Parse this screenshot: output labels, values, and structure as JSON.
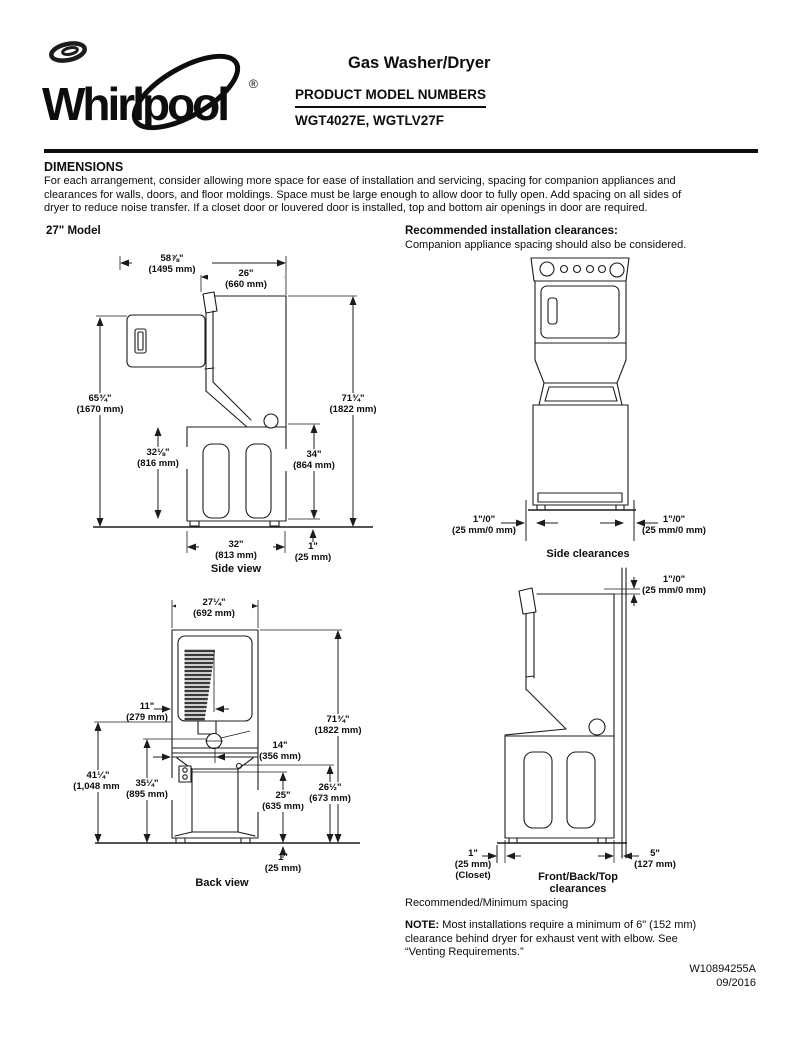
{
  "header": {
    "brand": "Whirlpool",
    "registered": "®",
    "product_title": "Gas Washer/Dryer",
    "subtitle": "PRODUCT MODEL NUMBERS",
    "model_numbers": "WGT4027E, WGTLV27F"
  },
  "intro": {
    "heading": "DIMENSIONS",
    "line1": "For each arrangement, consider allowing more space for ease of installation and servicing, spacing for companion appliances and",
    "line2": "clearances for walls, doors, and floor moldings. Space must be large enough to allow door to fully open. Add spacing on all sides of",
    "line3": "dryer to reduce noise transfer. If a closet door or louvered door is installed, top and bottom air openings in door are required.",
    "left_heading": "27\" Model",
    "right_heading": "Recommended installation clearances:",
    "right_subtext": "Companion appliance spacing should also be considered."
  },
  "side_view": {
    "caption": "Side view",
    "depth_total_in": "58⅞\"",
    "depth_total_mm": "(1495 mm)",
    "depth_top_in": "26\"",
    "depth_top_mm": "(660 mm)",
    "height_door_in": "65¾\"",
    "height_door_mm": "(1670 mm)",
    "height_total_in": "71¾\"",
    "height_total_mm": "(1822 mm)",
    "washer_height_left_in": "32⅛\"",
    "washer_height_left_mm": "(816 mm)",
    "washer_height_right_in": "34\"",
    "washer_height_right_mm": "(864 mm)",
    "base_depth_in": "32\"",
    "base_depth_mm": "(813 mm)",
    "feet_in": "1\"",
    "feet_mm": "(25 mm)"
  },
  "side_clearances": {
    "caption": "Side clearances",
    "left_in": "1\"/0\"",
    "left_mm": "(25 mm/0 mm)",
    "right_in": "1\"/0\"",
    "right_mm": "(25 mm/0 mm)"
  },
  "back_view": {
    "caption": "Back view",
    "width_in": "27¼\"",
    "width_mm": "(692 mm)",
    "vent_in": "11\"",
    "vent_mm": "(279 mm)",
    "height_total_in": "71¾\"",
    "height_total_mm": "(1822 mm)",
    "exhaust_in": "14\"",
    "exhaust_mm": "(356 mm)",
    "hookup_in": "41¼\"",
    "hookup_mm": "(1,048 mm)",
    "exhaust_height_in": "35¼\"",
    "exhaust_height_mm": "(895 mm)",
    "drain_in": "25\"",
    "drain_mm": "(635 mm)",
    "inlet_in": "26½\"",
    "inlet_mm": "(673 mm)",
    "feet_in": "1\"",
    "feet_mm": "(25 mm)"
  },
  "fbt_clearances": {
    "caption_line1": "Front/Back/Top",
    "caption_line2": "clearances",
    "top_in": "1\"/0\"",
    "top_mm": "(25 mm/0 mm)",
    "front_in": "1\"",
    "front_mm": "(25 mm)",
    "front_note": "(Closet)",
    "back_in": "5\"",
    "back_mm": "(127 mm)"
  },
  "footer_notes": {
    "spacing": "Recommended/Minimum spacing",
    "note_label": "NOTE:",
    "note_line1": " Most installations require a minimum of 6\" (152 mm)",
    "note_line2": "clearance behind dryer for exhaust vent with elbow. See",
    "note_line3": "“Venting Requirements.”",
    "doc_number": "W10894255A",
    "doc_date": "09/2016"
  }
}
